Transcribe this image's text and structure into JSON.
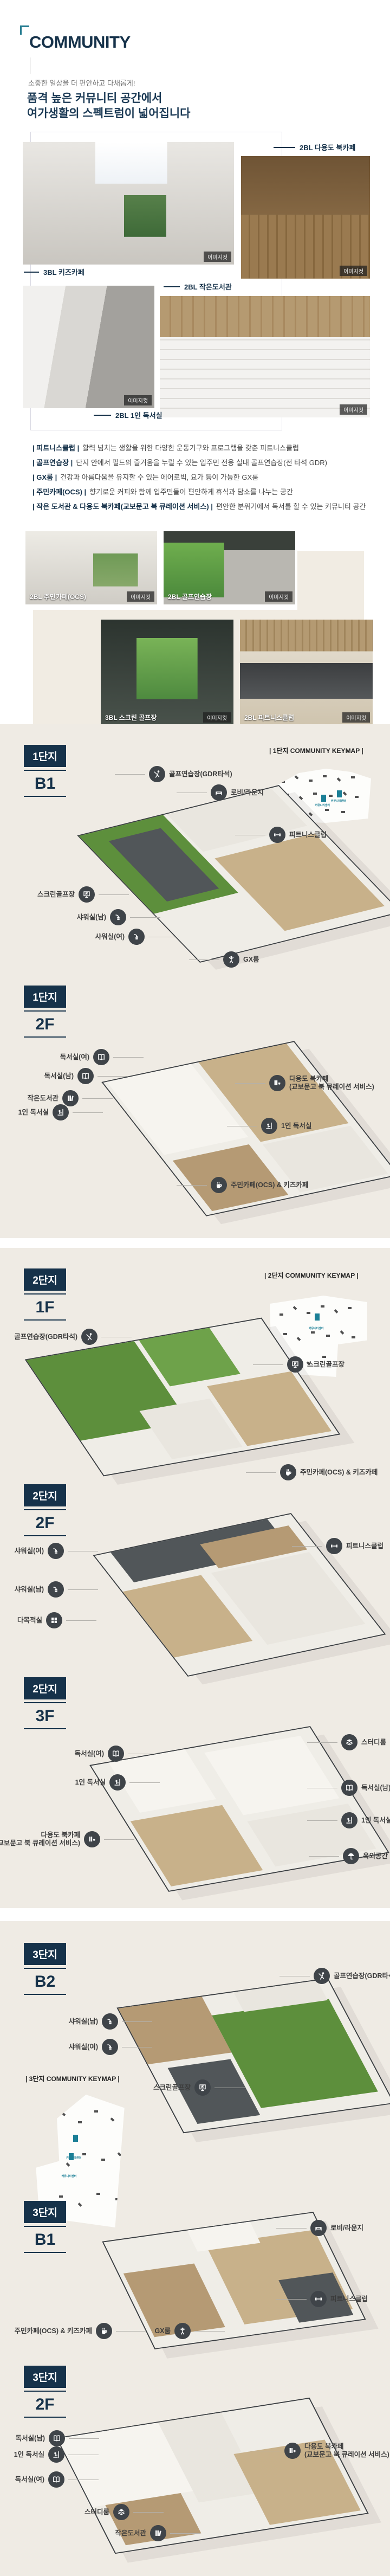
{
  "colors": {
    "accent_navy": "#16324a",
    "accent_teal": "#2b7f93",
    "section_beige": "#efebe4",
    "icon_circle": "#3f4449",
    "keymap_teal": "#1b7f96"
  },
  "page": {
    "title": "COMMUNITY",
    "subtitle": "소중한 일상을 더 편안하고 다채롭게!",
    "heading_line1": "품격 높은 커뮤니티 공간에서",
    "heading_line2": "여가생활의 스펙트럼이 넓어집니다"
  },
  "photo_badge": "이미지컷",
  "gallery_top": [
    {
      "caption": "3BL 키즈카페"
    },
    {
      "caption": "2BL 다용도 북카페"
    },
    {
      "caption": "2BL 작은도서관"
    },
    {
      "caption": "2BL 1인 독서실"
    }
  ],
  "features": [
    {
      "label": "| 피트니스클럽 |",
      "desc": "활력 넘치는 생활을 위한 다양한 운동기구와 프로그램을 갖춘 피트니스클럽"
    },
    {
      "label": "| 골프연습장 |",
      "desc": "단지 안에서 필드의 즐거움을 누릴 수 있는 입주민 전용 실내 골프연습장(전 타석 GDR)"
    },
    {
      "label": "| GX룸 |",
      "desc": "건강과 아름다움을 유지할 수 있는 에어로빅, 요가 등이 가능한 GX룸"
    },
    {
      "label": "| 주민카페(OCS) |",
      "desc": "향기로운 커피와 함께 입주민들이 편안하게 휴식과 담소를 나누는 공간"
    },
    {
      "label": "| 작은 도서관 & 다용도 북카페(교보문고 북 큐레이션 서비스) |",
      "desc": "편안한 분위기에서 독서를 할 수 있는 커뮤니티 공간"
    }
  ],
  "gallery_bottom": [
    {
      "caption": "2BL 주민카페(OCS)"
    },
    {
      "caption": "2BL 골프연습장"
    },
    {
      "caption": "3BL 스크린 골프장"
    },
    {
      "caption": "2BL 피트니스클럽"
    }
  ],
  "floor_sections": [
    {
      "complex": "1단지",
      "floor": "B1",
      "keymap_title": "| 1단지 COMMUNITY KEYMAP |",
      "keymap_highlight": "커뮤니티센터",
      "labels": [
        {
          "text": "골프연습장(GDR타석)",
          "icon": "golf-icon"
        },
        {
          "text": "로비/라운지",
          "icon": "lobby-lounge-icon"
        },
        {
          "text": "피트니스클럽",
          "icon": "fitness-icon"
        },
        {
          "text": "스크린골프장",
          "icon": "screen-golf-icon"
        },
        {
          "text": "샤워실(남)",
          "icon": "shower-icon"
        },
        {
          "text": "샤워실(여)",
          "icon": "shower-icon"
        },
        {
          "text": "GX룸",
          "icon": "gx-icon"
        }
      ]
    },
    {
      "complex": "1단지",
      "floor": "2F",
      "labels": [
        {
          "text": "독서실(여)",
          "icon": "reading-room-icon"
        },
        {
          "text": "독서실(남)",
          "icon": "reading-room-icon"
        },
        {
          "text": "작은도서관",
          "icon": "library-icon"
        },
        {
          "text": "1인 독서실",
          "icon": "single-reading-icon"
        },
        {
          "text": "다용도 북카페",
          "text2": "(교보문고 북 큐레이션 서비스)",
          "icon": "book-cafe-icon"
        },
        {
          "text": "1인 독서실",
          "icon": "single-reading-icon"
        },
        {
          "text": "주민카페(OCS) & 키즈카페",
          "icon": "cafe-icon"
        }
      ]
    },
    {
      "complex": "2단지",
      "floor": "1F",
      "keymap_title": "| 2단지 COMMUNITY KEYMAP |",
      "keymap_highlight": "커뮤니티센터",
      "labels": [
        {
          "text": "골프연습장(GDR타석)",
          "icon": "golf-icon"
        },
        {
          "text": "스크린골프장",
          "icon": "screen-golf-icon"
        },
        {
          "text": "주민카페(OCS) & 키즈카페",
          "icon": "cafe-icon"
        }
      ]
    },
    {
      "complex": "2단지",
      "floor": "2F",
      "labels": [
        {
          "text": "샤워실(여)",
          "icon": "shower-icon"
        },
        {
          "text": "샤워실(남)",
          "icon": "shower-icon"
        },
        {
          "text": "다목적실",
          "icon": "multipurpose-icon"
        },
        {
          "text": "피트니스클럽",
          "icon": "fitness-icon"
        }
      ]
    },
    {
      "complex": "2단지",
      "floor": "3F",
      "labels": [
        {
          "text": "독서실(여)",
          "icon": "reading-room-icon"
        },
        {
          "text": "1인 독서실",
          "icon": "single-reading-icon"
        },
        {
          "text": "다용도 북카페",
          "text2": "(교보문고 북 큐레이션 서비스)",
          "icon": "book-cafe-icon"
        },
        {
          "text": "스터디룸",
          "icon": "study-icon"
        },
        {
          "text": "독서실(남)",
          "icon": "reading-room-icon"
        },
        {
          "text": "1인 독서실",
          "icon": "single-reading-icon"
        },
        {
          "text": "옥외공간",
          "icon": "outdoor-icon"
        }
      ]
    },
    {
      "complex": "3단지",
      "floor": "B2",
      "keymap_title": "| 3단지 COMMUNITY KEYMAP |",
      "keymap_highlight": "커뮤니티센터",
      "labels": [
        {
          "text": "골프연습장(GDR타석)",
          "icon": "golf-icon"
        },
        {
          "text": "샤워실(남)",
          "icon": "shower-icon"
        },
        {
          "text": "샤워실(여)",
          "icon": "shower-icon"
        },
        {
          "text": "스크린골프장",
          "icon": "screen-golf-icon"
        }
      ]
    },
    {
      "complex": "3단지",
      "floor": "B1",
      "labels": [
        {
          "text": "로비/라운지",
          "icon": "lobby-lounge-icon"
        },
        {
          "text": "피트니스클럽",
          "icon": "fitness-icon"
        },
        {
          "text": "주민카페(OCS) & 키즈카페",
          "icon": "cafe-icon"
        },
        {
          "text": "GX룸",
          "icon": "gx-icon"
        }
      ]
    },
    {
      "complex": "3단지",
      "floor": "2F",
      "labels": [
        {
          "text": "독서실(남)",
          "icon": "reading-room-icon"
        },
        {
          "text": "1인 독서실",
          "icon": "single-reading-icon"
        },
        {
          "text": "독서실(여)",
          "icon": "reading-room-icon"
        },
        {
          "text": "스터디룸",
          "icon": "study-icon"
        },
        {
          "text": "작은도서관",
          "icon": "library-icon"
        },
        {
          "text": "다용도 북카페",
          "text2": "(교보문고 북 큐레이션 서비스)",
          "icon": "book-cafe-icon"
        }
      ]
    }
  ]
}
